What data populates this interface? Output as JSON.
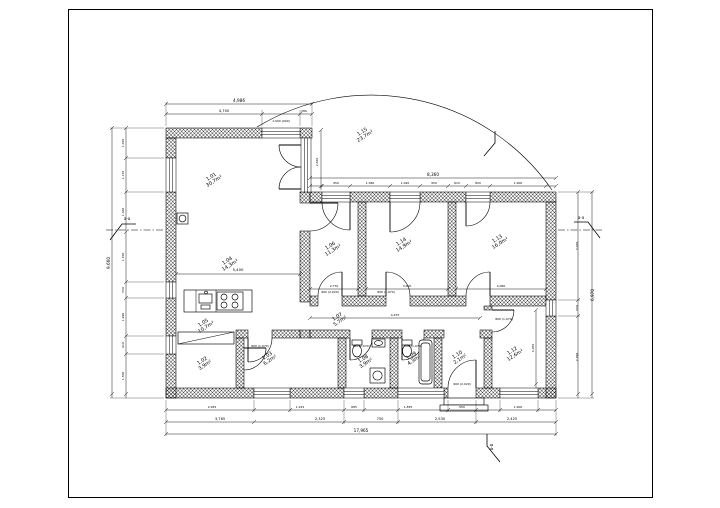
{
  "drawing": {
    "type": "architectural-floor-plan",
    "room_labels": [
      {
        "no": "1.01",
        "area": "30,7m²",
        "x": 212,
        "y": 178
      },
      {
        "no": "1.04",
        "area": "14,3m²",
        "x": 228,
        "y": 262
      },
      {
        "no": "1.05",
        "area": "10,7m²",
        "x": 204,
        "y": 324
      },
      {
        "no": "1.15",
        "area": "23,7m²",
        "x": 363,
        "y": 133
      },
      {
        "no": "1.06",
        "area": "11,3m²",
        "x": 331,
        "y": 247
      },
      {
        "no": "1.14",
        "area": "14,9m²",
        "x": 402,
        "y": 243
      },
      {
        "no": "1.13",
        "area": "16,0m²",
        "x": 498,
        "y": 240
      },
      {
        "no": "1.07",
        "area": "5,7m²",
        "x": 338,
        "y": 318
      },
      {
        "no": "1.02",
        "area": "3,9m²",
        "x": 203,
        "y": 362
      },
      {
        "no": "1.03",
        "area": "6,2m²",
        "x": 268,
        "y": 357
      },
      {
        "no": "1.08",
        "area": "3,9m²",
        "x": 364,
        "y": 360
      },
      {
        "no": "1.09",
        "area": "4,3m²",
        "x": 412,
        "y": 357
      },
      {
        "no": "1.10",
        "area": "2,1m²",
        "x": 458,
        "y": 356
      },
      {
        "no": "1.12",
        "area": "12,6m²",
        "x": 513,
        "y": 352
      }
    ],
    "dimensions": {
      "top": [
        {
          "v": "4,986",
          "x": 239,
          "y": 102,
          "s": 4.2
        },
        {
          "v": "4,700",
          "x": 224,
          "y": 112,
          "s": 3.6
        },
        {
          "v": "286",
          "x": 304,
          "y": 112,
          "s": 3.0
        },
        {
          "v": "1,500 (900)",
          "x": 281,
          "y": 122,
          "s": 3.0
        },
        {
          "v": "8,360",
          "x": 433,
          "y": 176,
          "s": 4.2
        },
        {
          "v": "950",
          "x": 336,
          "y": 184,
          "s": 3.0
        },
        {
          "v": "1,360",
          "x": 370,
          "y": 184,
          "s": 3.0
        },
        {
          "v": "1,020",
          "x": 405,
          "y": 184,
          "s": 3.0
        },
        {
          "v": "950",
          "x": 434,
          "y": 184,
          "s": 3.0
        },
        {
          "v": "610",
          "x": 457,
          "y": 184,
          "s": 3.0
        },
        {
          "v": "820",
          "x": 478,
          "y": 184,
          "s": 3.0
        },
        {
          "v": "1,900",
          "x": 518,
          "y": 184,
          "s": 3.0
        }
      ],
      "bottom": [
        {
          "v": "2,955",
          "x": 212,
          "y": 408,
          "s": 3.0
        },
        {
          "v": "1,225",
          "x": 300,
          "y": 408,
          "s": 3.0
        },
        {
          "v": "685",
          "x": 354,
          "y": 408,
          "s": 3.0
        },
        {
          "v": "1,835",
          "x": 408,
          "y": 408,
          "s": 3.0
        },
        {
          "v": "950",
          "x": 462,
          "y": 408,
          "s": 3.0
        },
        {
          "v": "1,900",
          "x": 518,
          "y": 408,
          "s": 3.0
        },
        {
          "v": "3,765",
          "x": 220,
          "y": 420,
          "s": 3.6
        },
        {
          "v": "2,325",
          "x": 320,
          "y": 420,
          "s": 3.6
        },
        {
          "v": "750",
          "x": 380,
          "y": 420,
          "s": 3.6
        },
        {
          "v": "2,530",
          "x": 440,
          "y": 420,
          "s": 3.6
        },
        {
          "v": "2,425",
          "x": 512,
          "y": 420,
          "s": 3.6
        },
        {
          "v": "17,965",
          "x": 361,
          "y": 432,
          "s": 4.2
        }
      ],
      "left": [
        {
          "v": "9,660",
          "x": 110,
          "y": 263,
          "r": -90,
          "s": 4.2
        },
        {
          "v": "1,030",
          "x": 124,
          "y": 143,
          "r": -90,
          "s": 3.0
        },
        {
          "v": "1,170",
          "x": 124,
          "y": 175,
          "r": -90,
          "s": 3.0
        },
        {
          "v": "1,360",
          "x": 124,
          "y": 212,
          "r": -90,
          "s": 3.0
        },
        {
          "v": "1,700",
          "x": 124,
          "y": 257,
          "r": -90,
          "s": 3.0
        },
        {
          "v": "550",
          "x": 124,
          "y": 290,
          "r": -90,
          "s": 3.0
        },
        {
          "v": "1,290",
          "x": 124,
          "y": 317,
          "r": -90,
          "s": 3.0
        },
        {
          "v": "610",
          "x": 124,
          "y": 345,
          "r": -90,
          "s": 3.0
        },
        {
          "v": "1,500",
          "x": 124,
          "y": 376,
          "r": -90,
          "s": 3.0
        }
      ],
      "right": [
        {
          "v": "6,970",
          "x": 594,
          "y": 295,
          "r": -90,
          "s": 4.2
        },
        {
          "v": "3,670",
          "x": 578,
          "y": 246,
          "r": -90,
          "s": 3.0
        },
        {
          "v": "550",
          "x": 578,
          "y": 308,
          "r": -90,
          "s": 3.0
        },
        {
          "v": "2,790",
          "x": 578,
          "y": 357,
          "r": -90,
          "s": 3.0
        }
      ],
      "interior": [
        {
          "v": "5,400",
          "x": 238,
          "y": 271,
          "s": 3.8
        },
        {
          "v": "2,770",
          "x": 334,
          "y": 287,
          "s": 3.0
        },
        {
          "v": "3,000",
          "x": 407,
          "y": 287,
          "s": 3.0
        },
        {
          "v": "4,060",
          "x": 501,
          "y": 287,
          "s": 3.0
        },
        {
          "v": "4,475",
          "x": 395,
          "y": 316,
          "s": 3.0
        },
        {
          "v": "4,050",
          "x": 534,
          "y": 348,
          "r": -90,
          "s": 3.0
        },
        {
          "v": "2,630",
          "x": 318,
          "y": 162,
          "r": -90,
          "s": 3.0
        }
      ],
      "door_tags": [
        {
          "v": "800 (1,970)",
          "x": 260,
          "y": 347,
          "s": 3.0
        },
        {
          "v": "700 (1,970)",
          "x": 361,
          "y": 347,
          "s": 3.0
        },
        {
          "v": "700 (1,970)",
          "x": 413,
          "y": 347,
          "s": 3.0
        },
        {
          "v": "800 (1,970)",
          "x": 504,
          "y": 320,
          "s": 3.0
        },
        {
          "v": "900 (2,020)",
          "x": 330,
          "y": 293,
          "s": 3.0
        },
        {
          "v": "800 (1,970)",
          "x": 386,
          "y": 293,
          "s": 3.0
        },
        {
          "v": "900 (2,020)",
          "x": 462,
          "y": 385,
          "s": 3.0
        }
      ]
    },
    "section_markers": [
      {
        "label": "a-a",
        "x": 127,
        "y": 220,
        "s": 4
      },
      {
        "label": "a-a",
        "x": 581,
        "y": 219,
        "s": 4
      },
      {
        "label": "b-b",
        "x": 493,
        "y": 447,
        "r": -90,
        "s": 4
      }
    ]
  }
}
